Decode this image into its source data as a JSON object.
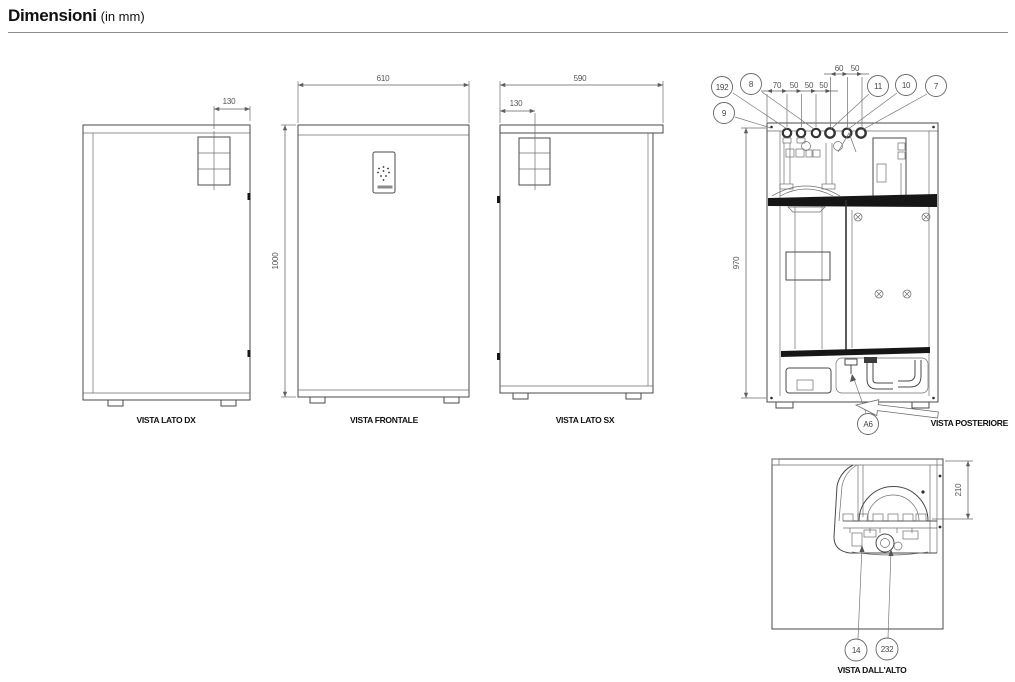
{
  "header": {
    "title": "Dimensioni",
    "unit_note": "(in mm)"
  },
  "views": {
    "lato_dx": {
      "label": "VISTA LATO DX",
      "dims": {
        "d130": "130"
      }
    },
    "frontale": {
      "label": "VISTA FRONTALE",
      "dims": {
        "d610": "610",
        "d1000": "1000"
      }
    },
    "lato_sx": {
      "label": "VISTA LATO SX",
      "dims": {
        "d590": "590",
        "d130": "130"
      }
    },
    "posteriore": {
      "label": "VISTA POSTERIORE",
      "dims": {
        "d970": "970",
        "chain_left": [
          "70",
          "50",
          "50",
          "50"
        ],
        "chain_right": [
          "60",
          "50"
        ]
      },
      "callouts": {
        "c192": "192",
        "c8": "8",
        "c9": "9",
        "c11": "11",
        "c10": "10",
        "c7": "7",
        "a6": "A6"
      }
    },
    "dall_alto": {
      "label": "VISTA DALL'ALTO",
      "dims": {
        "d210": "210"
      },
      "callouts": {
        "c14": "14",
        "c232": "232"
      }
    }
  },
  "colors": {
    "line": "#4a4a4a",
    "dim": "#5f5f5f",
    "band": "#161616",
    "label": "#111111"
  }
}
